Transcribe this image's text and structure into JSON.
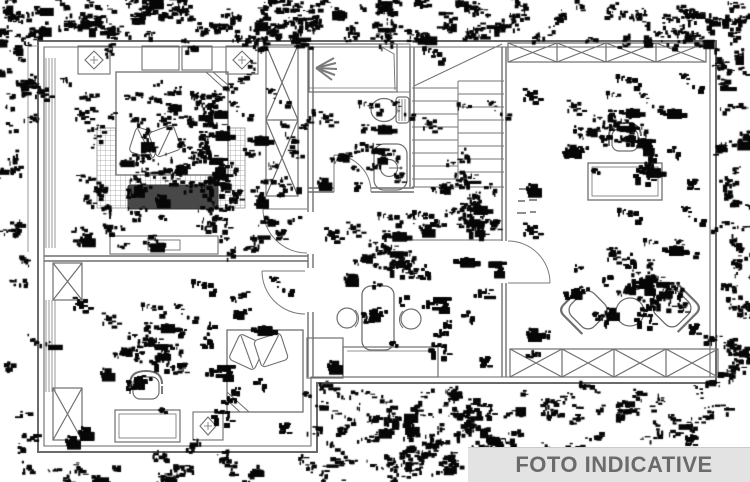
{
  "banner": {
    "label": "FOTO INDICATIVE"
  },
  "colors": {
    "paper": "#ffffff",
    "line": "#6a6a6a",
    "line_light": "#979797",
    "banner_bg": "#e3e3e3",
    "banner_text": "#6b6b6b",
    "noise": "#070707",
    "dark_furniture": "#454545"
  },
  "plan": {
    "kind": "apartment-floor-plan-scan",
    "elements": [
      "double-bed",
      "pillows",
      "area-rug",
      "foot-bench",
      "dresser",
      "wardrobe-x-panel",
      "ceiling-light",
      "shower",
      "toilet",
      "sink",
      "staircase",
      "desk",
      "office-chair",
      "kitchen-table",
      "stools",
      "kitchen-counter",
      "armchair",
      "side-table",
      "window-band",
      "door-swing"
    ]
  }
}
